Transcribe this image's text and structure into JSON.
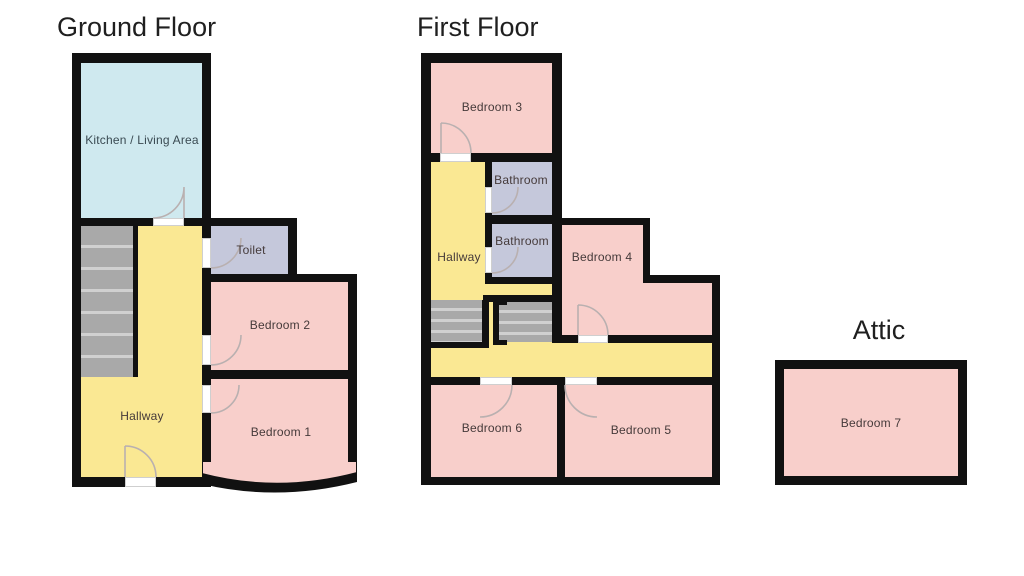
{
  "document": {
    "type": "property-floorplan",
    "background": "#ffffff"
  },
  "colors": {
    "wall": "#111111",
    "bedroom_fill": "#f8cfcb",
    "hallway_fill": "#fae893",
    "kitchen_fill": "#cfe9ef",
    "bathroom_fill": "#c5c8db",
    "stairs_fill": "#a9a9a9",
    "stair_tread_line": "#d0d0d0",
    "door_arc": "#b9b0b0",
    "title_text": "#1f1f1f",
    "label_text": "#453a3a"
  },
  "ground_floor": {
    "title": "Ground Floor",
    "rooms": {
      "kitchen": {
        "label": "Kitchen / Living Area"
      },
      "toilet": {
        "label": "Toilet"
      },
      "hallway": {
        "label": "Hallway"
      },
      "bedroom2": {
        "label": "Bedroom 2"
      },
      "bedroom1": {
        "label": "Bedroom 1"
      }
    }
  },
  "first_floor": {
    "title": "First Floor",
    "rooms": {
      "bedroom3": {
        "label": "Bedroom 3"
      },
      "bathroom_top": {
        "label": "Bathroom"
      },
      "bathroom_bottom": {
        "label": "Bathroom"
      },
      "hallway": {
        "label": "Hallway"
      },
      "bedroom4": {
        "label": "Bedroom 4"
      },
      "bedroom6": {
        "label": "Bedroom 6"
      },
      "bedroom5": {
        "label": "Bedroom 5"
      }
    }
  },
  "attic": {
    "title": "Attic",
    "rooms": {
      "bedroom7": {
        "label": "Bedroom 7"
      }
    }
  }
}
